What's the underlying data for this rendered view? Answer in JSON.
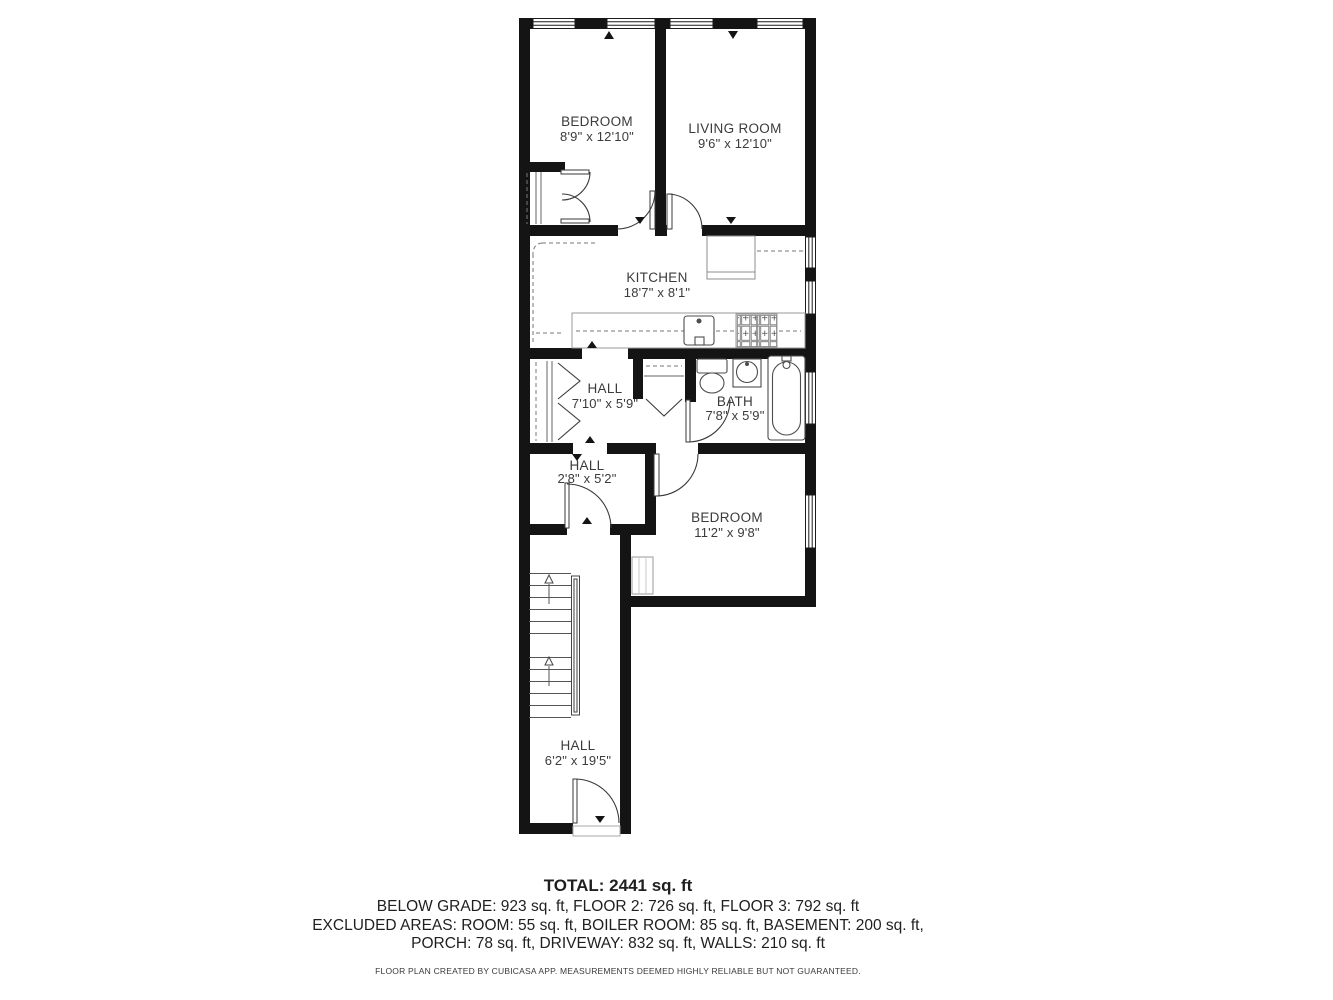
{
  "plan": {
    "rooms": [
      {
        "name": "BEDROOM",
        "dims": "8'9\" x 12'10\""
      },
      {
        "name": "LIVING ROOM",
        "dims": "9'6\" x 12'10\""
      },
      {
        "name": "KITCHEN",
        "dims": "18'7\" x 8'1\""
      },
      {
        "name": "HALL",
        "dims": "7'10\" x 5'9\""
      },
      {
        "name": "BATH",
        "dims": "7'8\" x 5'9\""
      },
      {
        "name": "HALL",
        "dims": "2'8\" x 5'2\""
      },
      {
        "name": "BEDROOM",
        "dims": "11'2\" x 9'8\""
      },
      {
        "name": "HALL",
        "dims": "6'2\" x 19'5\""
      }
    ]
  },
  "summary": {
    "total": "TOTAL: 2441 sq. ft",
    "floors": "BELOW GRADE: 923 sq. ft, FLOOR 2: 726 sq. ft, FLOOR 3: 792 sq. ft",
    "excluded1": "EXCLUDED AREAS: ROOM: 55 sq. ft, BOILER ROOM: 85 sq. ft, BASEMENT: 200 sq. ft,",
    "excluded2": "PORCH: 78 sq. ft, DRIVEWAY: 832 sq. ft, WALLS: 210 sq. ft",
    "disclaimer": "FLOOR PLAN CREATED BY CUBICASA APP. MEASUREMENTS DEEMED HIGHLY RELIABLE BUT NOT GUARANTEED."
  },
  "colors": {
    "wall": "#141414",
    "label_text": "#3b3b3b",
    "footer_text": "#1f1f1f",
    "fixture_stroke": "#4d4d4d"
  }
}
